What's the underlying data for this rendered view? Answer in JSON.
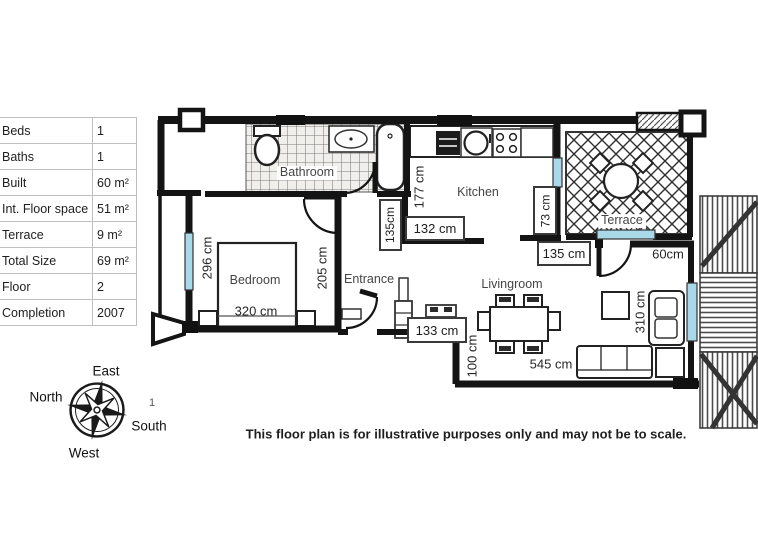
{
  "info_table": {
    "rows": [
      {
        "label": "Beds",
        "value": "1"
      },
      {
        "label": "Baths",
        "value": "1"
      },
      {
        "label": "Built",
        "value": "60 m²"
      },
      {
        "label": "Int. Floor space",
        "value": "51 m²"
      },
      {
        "label": "Terrace",
        "value": "9 m²"
      },
      {
        "label": "Total Size",
        "value": "69 m²"
      },
      {
        "label": "Floor",
        "value": "2"
      },
      {
        "label": "Completion",
        "value": "2007"
      }
    ]
  },
  "compass": {
    "top": "East",
    "left": "North",
    "right": "South",
    "bottom": "West",
    "stray_mark": "1"
  },
  "plan": {
    "rooms": {
      "bathroom": "Bathroom",
      "kitchen": "Kitchen",
      "terrace": "Terrace",
      "bedroom": "Bedroom",
      "entrance": "Entrance",
      "livingroom": "Livingroom"
    },
    "dimensions": {
      "bedroom_depth": "296 cm",
      "bedroom_width": "320 cm",
      "hall_depth": "205 cm",
      "hall_width": "135cm",
      "kitchen_depth": "177 cm",
      "kitchen_width": "132 cm",
      "kitchen_passage": "73 cm",
      "terrace_passage": "135 cm",
      "terrace_door": "60cm",
      "entrance_unit": "133 cm",
      "living_step": "100 cm",
      "living_width": "545 cm",
      "living_depth": "310 cm"
    }
  },
  "disclaimer": "This floor plan is for illustrative purposes only and may not be to scale.",
  "colors": {
    "window": "#a9d8e8",
    "wall": "#141414"
  }
}
